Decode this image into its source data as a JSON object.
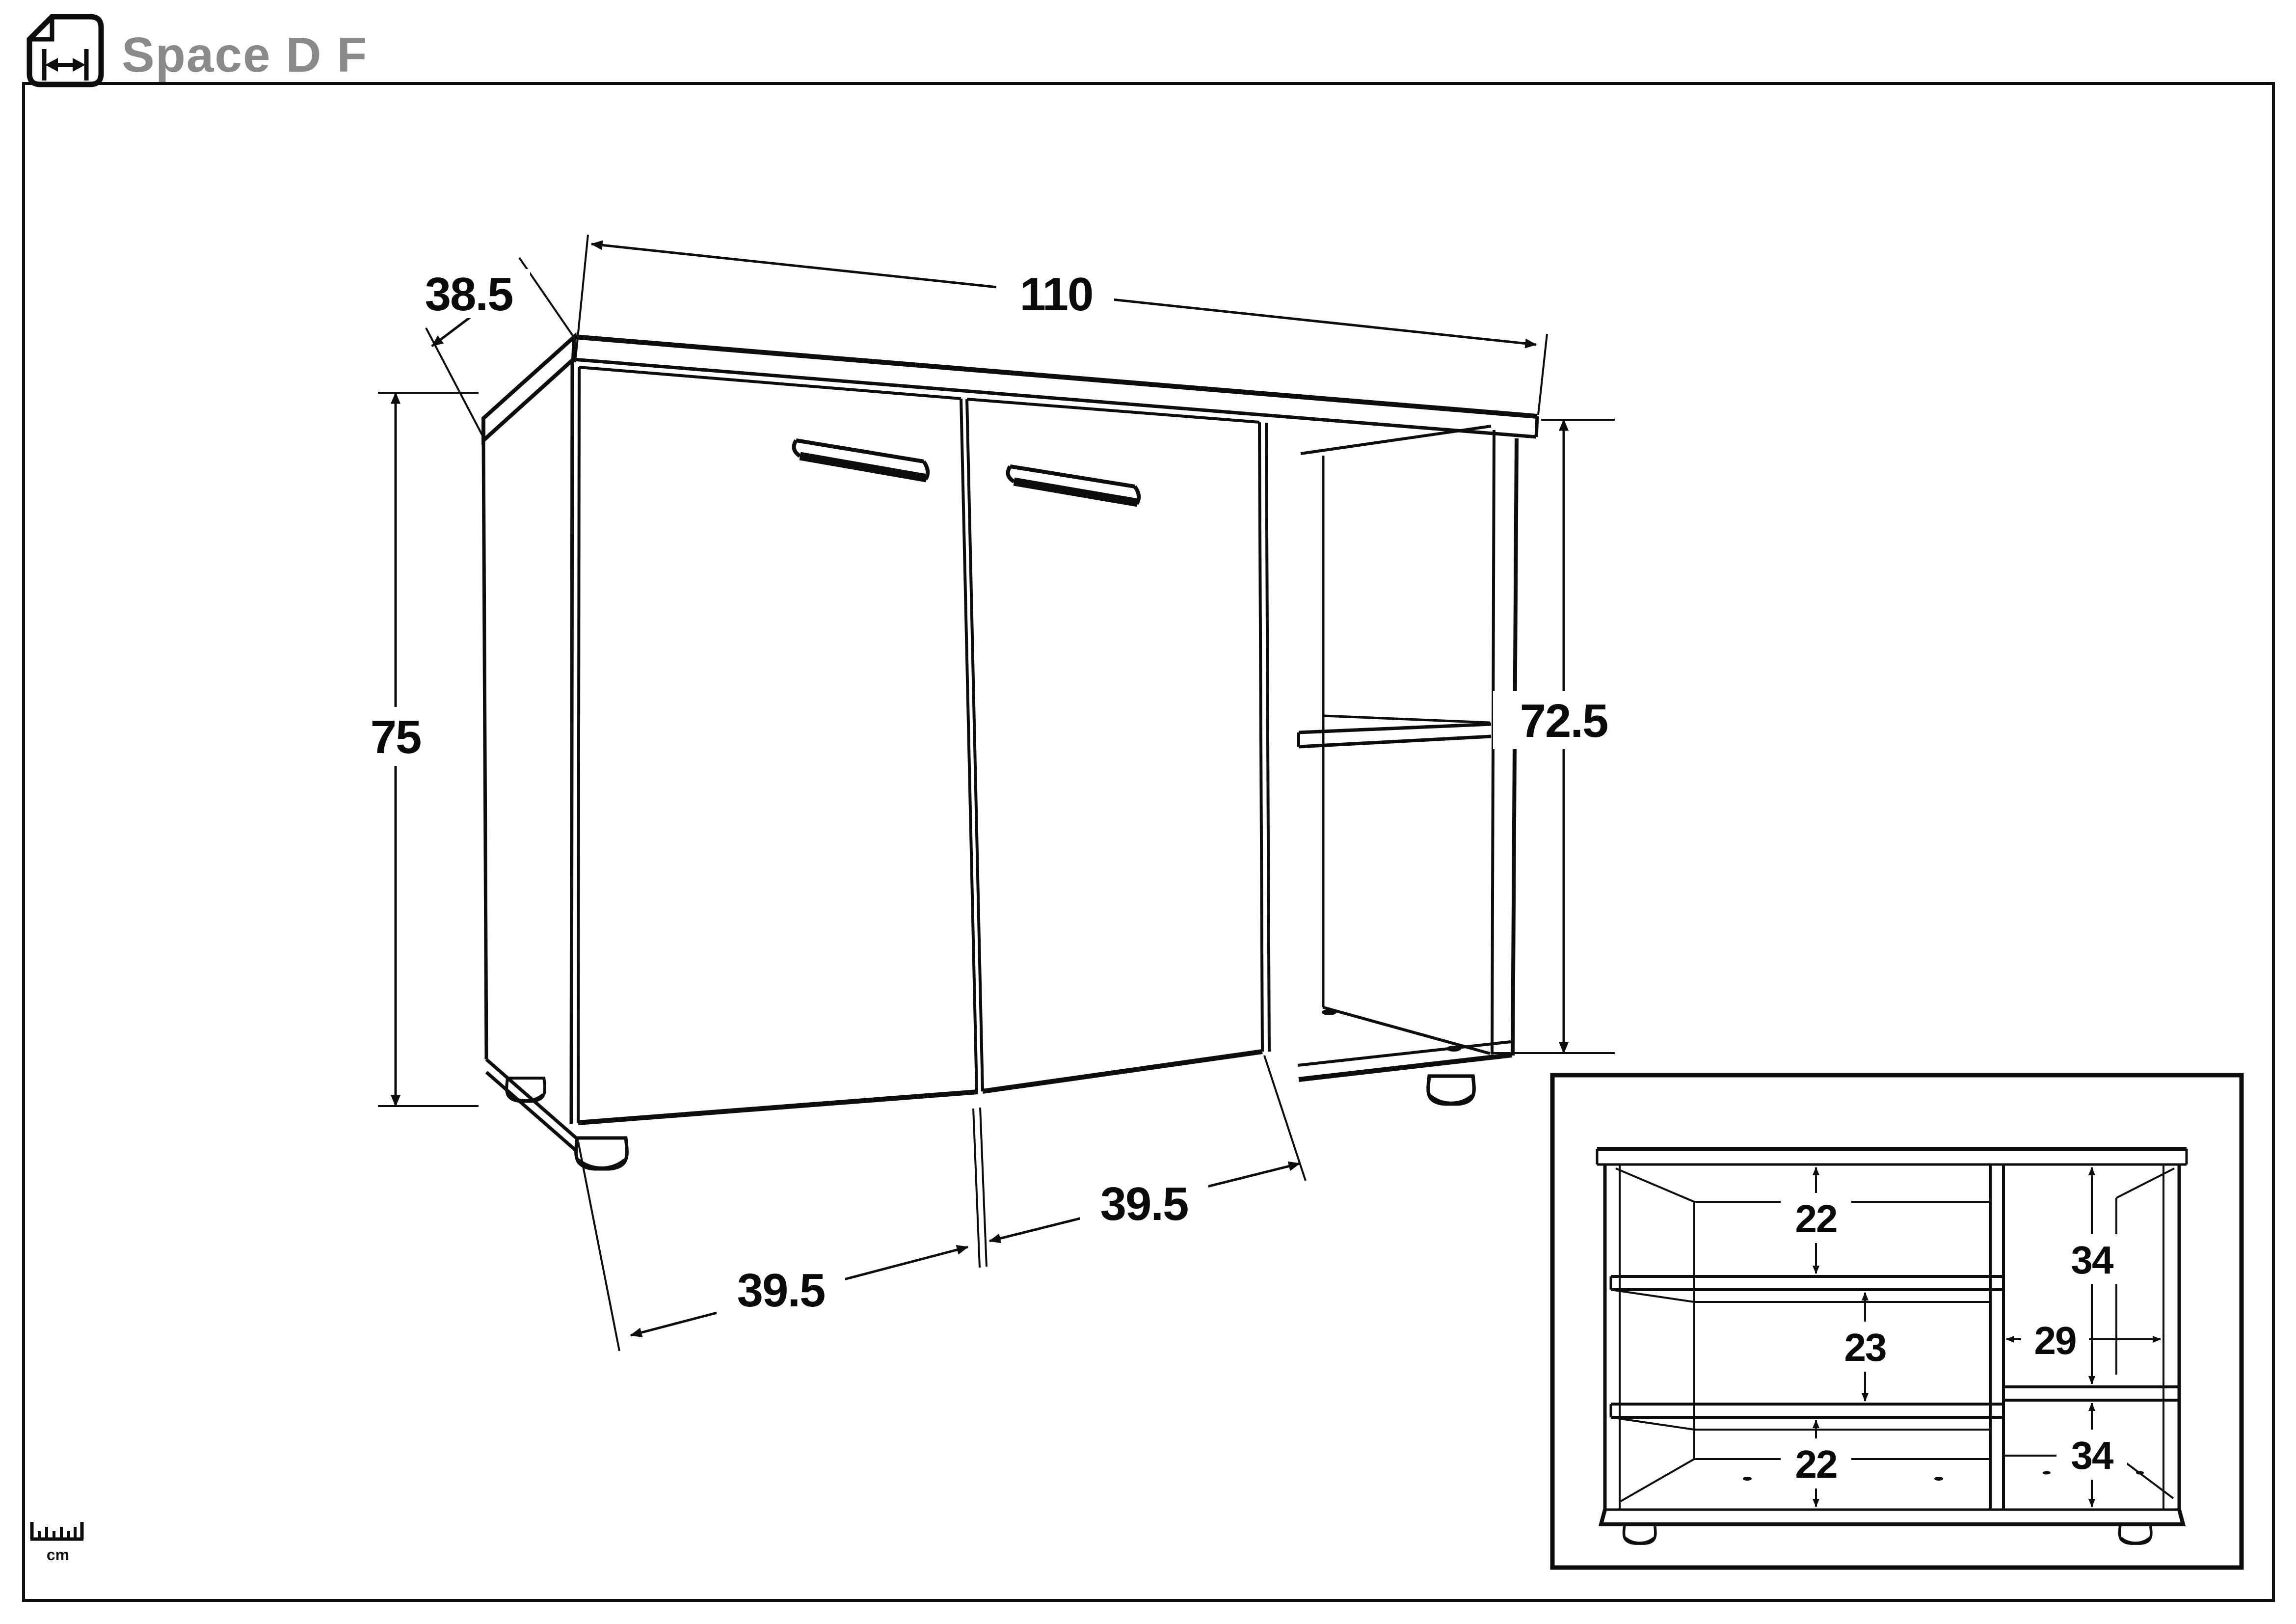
{
  "header": {
    "title": "Space D F",
    "icon": "width-dimension-page-icon"
  },
  "unit_legend": {
    "label": "cm",
    "icon": "ruler-icon"
  },
  "main_view": {
    "description": "perspective line drawing of two-door sideboard with open side shelves",
    "dims": {
      "width": {
        "value": "110"
      },
      "depth": {
        "value": "38.5"
      },
      "height": {
        "value": "75"
      },
      "side_height": {
        "value": "72.5"
      },
      "door_left_width": {
        "value": "39.5"
      },
      "door_right_width": {
        "value": "39.5"
      }
    }
  },
  "inset_view": {
    "description": "front interior view with shelf compartment dimensions",
    "dims": {
      "top_left_compartment": {
        "value": "22"
      },
      "middle_left_compartment": {
        "value": "23"
      },
      "bottom_left_compartment": {
        "value": "22"
      },
      "top_right_compartment": {
        "value": "34"
      },
      "right_section_width": {
        "value": "29"
      },
      "bottom_right_compartment": {
        "value": "34"
      }
    }
  },
  "colors": {
    "line": "#0d0d0d",
    "title": "#8a8a8a",
    "background": "#ffffff"
  }
}
